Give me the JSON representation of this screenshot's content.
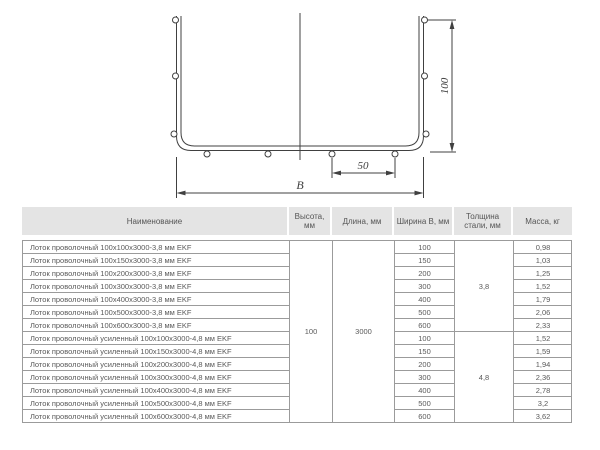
{
  "diagram": {
    "title": "wire-tray-cross-section",
    "dim_width_label": "B",
    "dim_height_label": "100",
    "dim_spacing_label": "50",
    "line_color": "#404040"
  },
  "table": {
    "headers": {
      "name": "Наименование",
      "height": "Высота, мм",
      "length": "Длина, мм",
      "width": "Ширина В, мм",
      "thickness": "Толщина стали, мм",
      "mass": "Масса, кг"
    },
    "merged": {
      "height": "100",
      "length": "3000",
      "thickness_group1": "3,8",
      "thickness_group2": "4,8"
    },
    "rows": [
      {
        "name": "Лоток проволочный 100х100х3000-3,8 мм EKF",
        "width": "100",
        "mass": "0,98"
      },
      {
        "name": "Лоток проволочный 100х150х3000-3,8 мм EKF",
        "width": "150",
        "mass": "1,03"
      },
      {
        "name": "Лоток проволочный 100х200х3000-3,8 мм EKF",
        "width": "200",
        "mass": "1,25"
      },
      {
        "name": "Лоток проволочный 100х300х3000-3,8 мм EKF",
        "width": "300",
        "mass": "1,52"
      },
      {
        "name": "Лоток проволочный 100х400х3000-3,8 мм EKF",
        "width": "400",
        "mass": "1,79"
      },
      {
        "name": "Лоток проволочный 100х500х3000-3,8 мм EKF",
        "width": "500",
        "mass": "2,06"
      },
      {
        "name": "Лоток проволочный 100х600х3000-3,8 мм EKF",
        "width": "600",
        "mass": "2,33"
      },
      {
        "name": "Лоток проволочный усиленный 100х100х3000-4,8 мм EKF",
        "width": "100",
        "mass": "1,52"
      },
      {
        "name": "Лоток проволочный усиленный 100х150х3000-4,8 мм EKF",
        "width": "150",
        "mass": "1,59"
      },
      {
        "name": "Лоток проволочный усиленный 100х200х3000-4,8 мм EKF",
        "width": "200",
        "mass": "1,94"
      },
      {
        "name": "Лоток проволочный усиленный 100х300х3000-4,8 мм EKF",
        "width": "300",
        "mass": "2,36"
      },
      {
        "name": "Лоток проволочный усиленный 100х400х3000-4,8 мм EKF",
        "width": "400",
        "mass": "2,78"
      },
      {
        "name": "Лоток проволочный усиленный 100х500х3000-4,8 мм EKF",
        "width": "500",
        "mass": "3,2"
      },
      {
        "name": "Лоток проволочный усиленный 100х600х3000-4,8 мм EKF",
        "width": "600",
        "mass": "3,62"
      }
    ],
    "colors": {
      "border": "#9b9b9b",
      "header_bg": "#e4e4e4",
      "text": "#5a5a5a"
    }
  }
}
